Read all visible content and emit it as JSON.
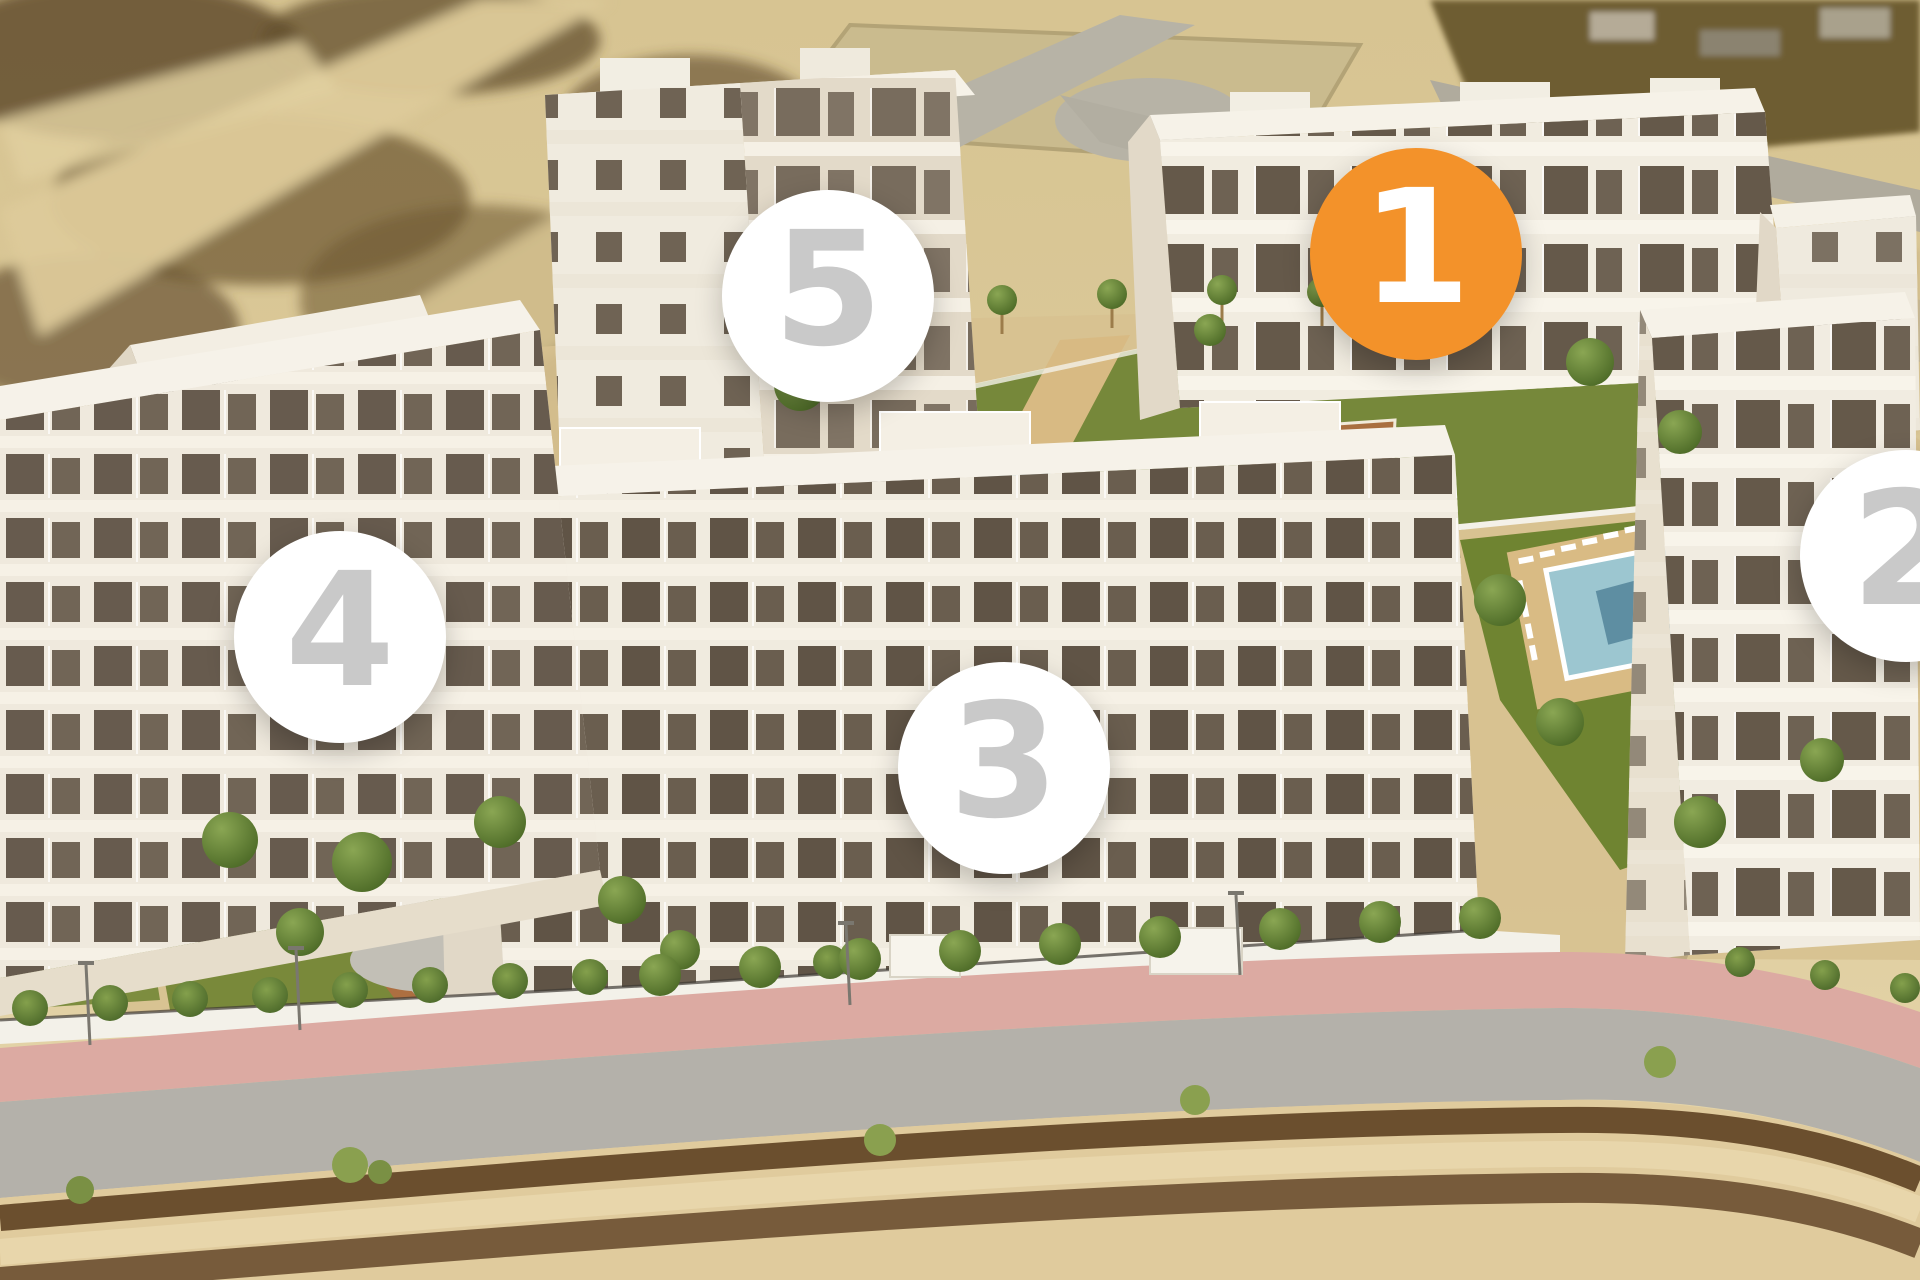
{
  "title": "residential-development-aerial-render",
  "markers": [
    {
      "label": "1",
      "x": 1416,
      "y": 254,
      "highlighted": true
    },
    {
      "label": "2",
      "x": 1906,
      "y": 556,
      "highlighted": false
    },
    {
      "label": "3",
      "x": 1004,
      "y": 768,
      "highlighted": false
    },
    {
      "label": "4",
      "x": 340,
      "y": 637,
      "highlighted": false
    },
    {
      "label": "5",
      "x": 828,
      "y": 296,
      "highlighted": false
    }
  ],
  "colors": {
    "highlight": "#F3922A",
    "highlight_text": "#FFFFFF",
    "marker_bg": "#FFFFFF",
    "marker_text": "#C9C9C9"
  }
}
